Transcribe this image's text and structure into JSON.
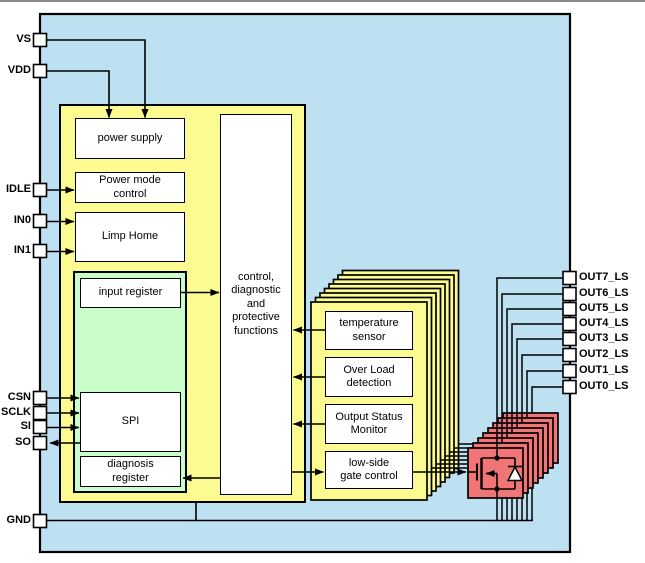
{
  "blocks": {
    "power_supply": "power supply",
    "power_mode": "Power mode\ncontrol",
    "limp_home": "Limp Home",
    "input_register": "input register",
    "spi": "SPI",
    "diagnosis_register": "diagnosis\nregister",
    "control": "control,\ndiagnostic\nand\nprotective\nfunctions",
    "temperature_sensor": "temperature\nsensor",
    "overload_detection": "Over Load\ndetection",
    "output_status": "Output Status\nMonitor",
    "lowside_gate": "low-side\ngate control"
  },
  "pins": {
    "left": [
      {
        "label": "VS",
        "y": 40
      },
      {
        "label": "VDD",
        "y": 71
      },
      {
        "label": "IDLE",
        "y": 190
      },
      {
        "label": "IN0",
        "y": 221
      },
      {
        "label": "IN1",
        "y": 251
      },
      {
        "label": "CSN",
        "y": 398
      },
      {
        "label": "SCLK",
        "y": 413
      },
      {
        "label": "SI",
        "y": 427
      },
      {
        "label": "SO",
        "y": 443
      },
      {
        "label": "GND",
        "y": 521
      }
    ],
    "right": [
      {
        "label": "OUT7_LS",
        "y": 278
      },
      {
        "label": "OUT6_LS",
        "y": 294
      },
      {
        "label": "OUT5_LS",
        "y": 309
      },
      {
        "label": "OUT4_LS",
        "y": 324
      },
      {
        "label": "OUT3_LS",
        "y": 339
      },
      {
        "label": "OUT2_LS",
        "y": 355
      },
      {
        "label": "OUT1_LS",
        "y": 371
      },
      {
        "label": "OUT0_LS",
        "y": 387
      }
    ]
  },
  "colors": {
    "chip_fill": "#bde1f1",
    "driver_fill": "#fbfb91",
    "register_fill": "#c9fdca",
    "mosfet_fill": "#ef7576",
    "box_fill": "#ffffff",
    "line": "#000000"
  },
  "stack_count": 8
}
